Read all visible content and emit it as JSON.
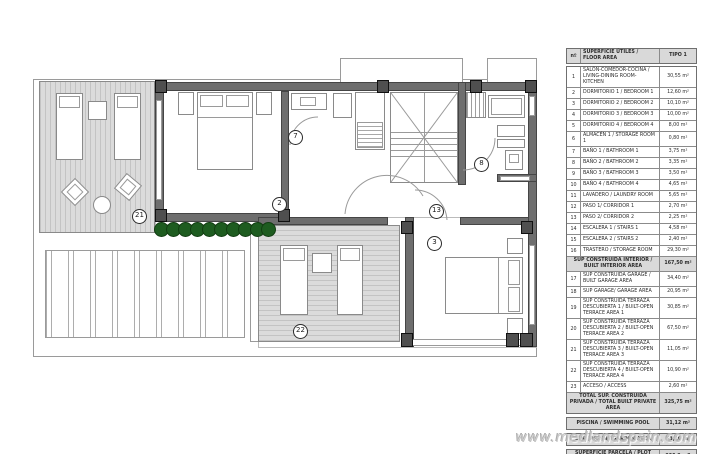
{
  "watermark": "www.medlandspain.com",
  "plan": {
    "labels": [
      {
        "id": "2"
      },
      {
        "id": "3"
      },
      {
        "id": "7"
      },
      {
        "id": "8"
      },
      {
        "id": "13"
      },
      {
        "id": "21"
      },
      {
        "id": "22"
      }
    ]
  },
  "table": {
    "header": {
      "col_num": "nº",
      "col_desc": "SUPERFICIE ÚTILES / FLOOR AREA",
      "col_val": "TIPO 1"
    },
    "rows": [
      {
        "type": "data",
        "size": "r2",
        "n": "1",
        "desc": "SALÓN-COMEDOR-COCINA / LIVING-DINING ROOM-KITCHEN",
        "val": "30,55 m²"
      },
      {
        "type": "data",
        "size": "r1",
        "n": "2",
        "desc": "DORMITORIO 1 / BEDROOM 1",
        "val": "12,60 m²"
      },
      {
        "type": "data",
        "size": "r1",
        "n": "3",
        "desc": "DORMITORIO 2 / BEDROOM 2",
        "val": "10,10 m²"
      },
      {
        "type": "data",
        "size": "r1",
        "n": "4",
        "desc": "DORMITORIO 3 / BEDROOM 3",
        "val": "10,00 m²"
      },
      {
        "type": "data",
        "size": "r1",
        "n": "5",
        "desc": "DORMITORIO 4 / BEDROOM 4",
        "val": "8,00 m²"
      },
      {
        "type": "data",
        "size": "r1",
        "n": "6",
        "desc": "ALMACÉN 1 / STORAGE ROOM 1",
        "val": "0,80 m²"
      },
      {
        "type": "data",
        "size": "r1",
        "n": "7",
        "desc": "BAÑO 1 / BATHROOM 1",
        "val": "3,75 m²"
      },
      {
        "type": "data",
        "size": "r1",
        "n": "8",
        "desc": "BAÑO 2 / BATHROOM 2",
        "val": "3,35 m²"
      },
      {
        "type": "data",
        "size": "r1",
        "n": "9",
        "desc": "BAÑO 3 / BATHROOM 3",
        "val": "3,50 m²"
      },
      {
        "type": "data",
        "size": "r1",
        "n": "10",
        "desc": "BAÑO 4 / BATHROOM 4",
        "val": "4,65 m²"
      },
      {
        "type": "data",
        "size": "r1",
        "n": "11",
        "desc": "LAVADERO / LAUNDRY ROOM",
        "val": "5,65 m²"
      },
      {
        "type": "data",
        "size": "r1",
        "n": "12",
        "desc": "PASO 1/ CORRIDOR 1",
        "val": "2,70 m²"
      },
      {
        "type": "data",
        "size": "r1",
        "n": "13",
        "desc": "PASO 2/ CORRIDOR 2",
        "val": "2,25 m²"
      },
      {
        "type": "data",
        "size": "r1",
        "n": "14",
        "desc": "ESCALERA 1 / STAIRS 1",
        "val": "4,58 m²"
      },
      {
        "type": "data",
        "size": "r1",
        "n": "15",
        "desc": "ESCALERA 2 / STAIRS 2",
        "val": "2,40 m²"
      },
      {
        "type": "data",
        "size": "r1",
        "n": "16",
        "desc": "TRASTERO / STORAGE ROOM",
        "val": "29,30 m²"
      },
      {
        "type": "section",
        "size": "r2",
        "desc": "SUP CONSTRUIDA INTERIOR / BUILT INTERIOR AREA",
        "val": "167,50 m²"
      },
      {
        "type": "data",
        "size": "r2",
        "n": "17",
        "desc": "SUP CONSTRUIDA GARAGE / BUILT GARAGE AREA",
        "val": "34,40 m²"
      },
      {
        "type": "data",
        "size": "r1",
        "n": "18",
        "desc": "SUP GARAGE/ GARAGE AREA",
        "val": "20,95 m²"
      },
      {
        "type": "data",
        "size": "r3",
        "n": "19",
        "desc": "SUP CONSTRUIDA TERRAZA DESCUBIERTA 1 / BUILT-OPEN TERRACE AREA 1",
        "val": "30,85 m²"
      },
      {
        "type": "data",
        "size": "r3",
        "n": "20",
        "desc": "SUP CONSTRUIDA TERRAZA DESCUBIERTA 2 / BUILT-OPEN TERRACE AREA 2",
        "val": "67,50 m²"
      },
      {
        "type": "data",
        "size": "r3",
        "n": "21",
        "desc": "SUP CONSTRUIDA TERRAZA DESCUBIERTA 3 / BUILT-OPEN TERRACE AREA 3",
        "val": "11,05 m²"
      },
      {
        "type": "data",
        "size": "r3",
        "n": "22",
        "desc": "SUP CONSTRUIDA TERRAZA DESCUBIERTA 4 / BUILT-OPEN TERRACE AREA 4",
        "val": "10,90 m²"
      },
      {
        "type": "data",
        "size": "r1",
        "n": "23",
        "desc": "ACCESO / ACCESS",
        "val": "2,60 m²"
      },
      {
        "type": "section",
        "size": "r2",
        "desc": "TOTAL SUP. CONSTRUIDA PRIVADA / TOTAL BUILT PRIVATE AREA",
        "val": "325,75 m²"
      }
    ],
    "footer_rows": [
      {
        "desc": "PISCINA / SWIMMING POOL",
        "val": "31,12 m²"
      },
      {
        "desc": "SUP. JARDIN / GARDEN AREA",
        "val": "63,10 m²"
      },
      {
        "desc": "SUPERFICIE PARCELA / PLOT AREA",
        "val": "300,3 m2"
      }
    ]
  }
}
